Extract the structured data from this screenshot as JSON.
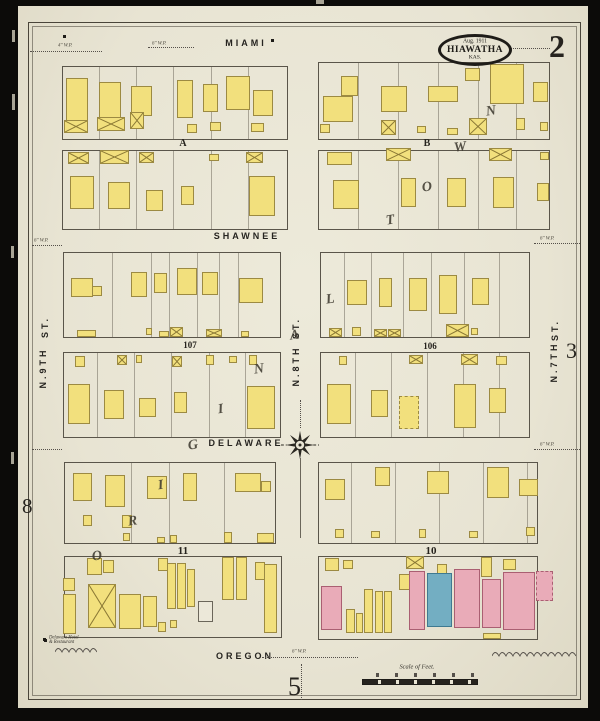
{
  "sheet": {
    "stamp": {
      "date": "Aug. 1911",
      "city": "HIAWATHA",
      "state": "KAS."
    },
    "sheet_number": "2",
    "adjacent_sheet_right": "3",
    "adjacent_sheet_left": "8",
    "adjacent_sheet_bottom": "5",
    "scale_label": "Scale of Feet.",
    "plat_name": "ORIGINAL TOWN",
    "note": {
      "line1": "Delaware Hotel",
      "line2": "& Restaurant"
    }
  },
  "colors": {
    "paper": "#e8e4d3",
    "frame_yellow": "#f2e07d",
    "brick_pink": "#e9abb8",
    "stone_blue": "#73aec2",
    "ink": "#26231e"
  },
  "map": {
    "street_labels": [
      {
        "t": "MIAMI",
        "x": 246,
        "y": 43,
        "r": 0
      },
      {
        "t": "SHAWNEE",
        "x": 247,
        "y": 236,
        "r": 0
      },
      {
        "t": "DELAWARE",
        "x": 246,
        "y": 443,
        "r": 0
      },
      {
        "t": "OREGON",
        "x": 245,
        "y": 656,
        "r": 0
      },
      {
        "t": "ST.",
        "x": 45,
        "y": 327,
        "r": -90
      },
      {
        "t": "N.9TH",
        "x": 43,
        "y": 368,
        "r": -90
      },
      {
        "t": "ST.",
        "x": 296,
        "y": 328,
        "r": -90
      },
      {
        "t": "N.8TH",
        "x": 296,
        "y": 366,
        "r": -90
      },
      {
        "t": "ST.",
        "x": 555,
        "y": 330,
        "r": -90
      },
      {
        "t": "N.7TH",
        "x": 554,
        "y": 362,
        "r": -90
      }
    ],
    "block_labels": [
      {
        "t": "A",
        "x": 183,
        "y": 138,
        "s": 10
      },
      {
        "t": "B",
        "x": 427,
        "y": 138,
        "s": 10
      },
      {
        "t": "107",
        "x": 190,
        "y": 340,
        "s": 9
      },
      {
        "t": "106",
        "x": 430,
        "y": 341,
        "s": 9
      },
      {
        "t": "11",
        "x": 183,
        "y": 545,
        "s": 11
      },
      {
        "t": "10",
        "x": 431,
        "y": 545,
        "s": 11
      }
    ],
    "plat_letters": [
      {
        "ch": "O",
        "x": 92,
        "y": 549
      },
      {
        "ch": "R",
        "x": 128,
        "y": 514
      },
      {
        "ch": "I",
        "x": 158,
        "y": 478
      },
      {
        "ch": "G",
        "x": 188,
        "y": 438
      },
      {
        "ch": "I",
        "x": 218,
        "y": 402
      },
      {
        "ch": "N",
        "x": 254,
        "y": 362
      },
      {
        "ch": "A",
        "x": 290,
        "y": 328
      },
      {
        "ch": "L",
        "x": 326,
        "y": 292
      },
      {
        "ch": "T",
        "x": 386,
        "y": 213
      },
      {
        "ch": "O",
        "x": 422,
        "y": 180
      },
      {
        "ch": "W",
        "x": 454,
        "y": 140
      },
      {
        "ch": "N",
        "x": 486,
        "y": 104
      }
    ],
    "blocks": [
      {
        "x": 62,
        "y": 66,
        "w": 226,
        "h": 74,
        "lots": [
          99,
          136,
          173,
          211,
          248
        ]
      },
      {
        "x": 318,
        "y": 62,
        "w": 232,
        "h": 78,
        "lots": [
          358,
          398,
          438,
          478,
          516
        ]
      },
      {
        "x": 62,
        "y": 150,
        "w": 226,
        "h": 80,
        "lots": [
          99,
          136,
          173,
          211,
          248
        ]
      },
      {
        "x": 318,
        "y": 150,
        "w": 232,
        "h": 80,
        "lots": [
          358,
          398,
          438,
          478,
          516
        ]
      },
      {
        "x": 63,
        "y": 252,
        "w": 218,
        "h": 86,
        "lots": [
          112,
          151,
          169,
          197,
          219,
          238
        ]
      },
      {
        "x": 320,
        "y": 252,
        "w": 210,
        "h": 86,
        "lots": [
          344,
          371,
          403,
          431,
          464,
          499
        ]
      },
      {
        "x": 63,
        "y": 352,
        "w": 218,
        "h": 86,
        "lots": [
          97,
          134,
          171,
          209,
          245
        ]
      },
      {
        "x": 320,
        "y": 352,
        "w": 210,
        "h": 86,
        "lots": [
          355,
          391,
          427,
          463,
          499
        ]
      },
      {
        "x": 64,
        "y": 462,
        "w": 212,
        "h": 82,
        "lots": [
          131,
          169,
          224
        ]
      },
      {
        "x": 318,
        "y": 462,
        "w": 220,
        "h": 82,
        "lots": [
          351,
          395,
          439,
          483,
          527
        ]
      },
      {
        "x": 64,
        "y": 556,
        "w": 218,
        "h": 82,
        "lots": []
      },
      {
        "x": 318,
        "y": 556,
        "w": 220,
        "h": 84,
        "lots": []
      }
    ],
    "buildings": [
      [
        66,
        78,
        22,
        44
      ],
      [
        99,
        82,
        22,
        38
      ],
      [
        131,
        86,
        21,
        30
      ],
      [
        177,
        80,
        16,
        38
      ],
      [
        203,
        84,
        15,
        28
      ],
      [
        226,
        76,
        24,
        34
      ],
      [
        253,
        90,
        20,
        26
      ],
      [
        64,
        120,
        24,
        13,
        "y",
        "x"
      ],
      [
        97,
        117,
        28,
        14,
        "y",
        "x"
      ],
      [
        130,
        112,
        14,
        17,
        "y",
        "x"
      ],
      [
        187,
        124,
        10,
        9
      ],
      [
        210,
        122,
        11,
        9
      ],
      [
        251,
        123,
        13,
        9
      ],
      [
        323,
        96,
        30,
        26
      ],
      [
        341,
        76,
        17,
        20
      ],
      [
        381,
        86,
        26,
        26
      ],
      [
        428,
        86,
        30,
        16
      ],
      [
        465,
        68,
        15,
        13
      ],
      [
        490,
        64,
        34,
        40
      ],
      [
        533,
        82,
        15,
        20
      ],
      [
        381,
        120,
        15,
        15,
        "y",
        "x"
      ],
      [
        469,
        118,
        18,
        17,
        "y",
        "x"
      ],
      [
        320,
        124,
        10,
        9
      ],
      [
        417,
        126,
        9,
        7
      ],
      [
        447,
        128,
        11,
        7
      ],
      [
        516,
        118,
        9,
        12
      ],
      [
        540,
        122,
        8,
        9
      ],
      [
        68,
        152,
        21,
        12,
        "y",
        "x"
      ],
      [
        100,
        150,
        29,
        14,
        "y",
        "x"
      ],
      [
        139,
        152,
        15,
        11,
        "y",
        "x"
      ],
      [
        246,
        152,
        17,
        11,
        "y",
        "x"
      ],
      [
        209,
        154,
        10,
        7
      ],
      [
        70,
        176,
        24,
        33
      ],
      [
        108,
        182,
        22,
        27
      ],
      [
        146,
        190,
        17,
        21
      ],
      [
        181,
        186,
        13,
        19
      ],
      [
        249,
        176,
        26,
        40
      ],
      [
        327,
        152,
        25,
        13
      ],
      [
        386,
        148,
        25,
        13,
        "y",
        "x"
      ],
      [
        489,
        148,
        23,
        13,
        "y",
        "x"
      ],
      [
        540,
        152,
        9,
        8
      ],
      [
        333,
        180,
        26,
        29
      ],
      [
        401,
        178,
        15,
        29
      ],
      [
        447,
        178,
        19,
        29
      ],
      [
        493,
        177,
        21,
        31
      ],
      [
        537,
        183,
        12,
        18
      ],
      [
        71,
        278,
        22,
        19
      ],
      [
        92,
        286,
        10,
        10
      ],
      [
        131,
        272,
        16,
        25
      ],
      [
        154,
        273,
        13,
        20
      ],
      [
        177,
        268,
        20,
        27
      ],
      [
        202,
        272,
        16,
        23
      ],
      [
        239,
        278,
        24,
        25
      ],
      [
        77,
        330,
        19,
        7
      ],
      [
        146,
        328,
        6,
        7
      ],
      [
        159,
        331,
        10,
        6
      ],
      [
        170,
        327,
        13,
        10,
        "y",
        "x"
      ],
      [
        206,
        329,
        16,
        8,
        "y",
        "x"
      ],
      [
        241,
        331,
        8,
        6
      ],
      [
        347,
        280,
        20,
        25
      ],
      [
        379,
        278,
        13,
        29
      ],
      [
        409,
        278,
        18,
        33
      ],
      [
        439,
        275,
        18,
        39
      ],
      [
        472,
        278,
        17,
        27
      ],
      [
        329,
        328,
        13,
        9,
        "y",
        "x"
      ],
      [
        352,
        327,
        9,
        9
      ],
      [
        374,
        329,
        13,
        8,
        "y",
        "x"
      ],
      [
        388,
        329,
        13,
        8,
        "y",
        "x"
      ],
      [
        446,
        324,
        23,
        13,
        "y",
        "x"
      ],
      [
        471,
        328,
        7,
        7
      ],
      [
        75,
        356,
        10,
        11
      ],
      [
        117,
        355,
        10,
        10,
        "y",
        "x"
      ],
      [
        136,
        355,
        6,
        8
      ],
      [
        172,
        356,
        10,
        11,
        "y",
        "x"
      ],
      [
        206,
        355,
        8,
        10
      ],
      [
        229,
        356,
        8,
        7
      ],
      [
        249,
        355,
        8,
        10
      ],
      [
        68,
        384,
        22,
        40
      ],
      [
        104,
        390,
        20,
        29
      ],
      [
        139,
        398,
        17,
        19
      ],
      [
        174,
        392,
        13,
        21
      ],
      [
        247,
        386,
        28,
        43
      ],
      [
        339,
        356,
        8,
        9
      ],
      [
        409,
        355,
        14,
        9,
        "y",
        "x"
      ],
      [
        461,
        354,
        17,
        11,
        "y",
        "x"
      ],
      [
        496,
        356,
        11,
        9
      ],
      [
        327,
        384,
        24,
        40
      ],
      [
        371,
        390,
        17,
        27
      ],
      [
        399,
        396,
        20,
        33,
        "y",
        "d"
      ],
      [
        454,
        384,
        22,
        44
      ],
      [
        489,
        388,
        17,
        25
      ],
      [
        73,
        473,
        19,
        28
      ],
      [
        105,
        475,
        20,
        32
      ],
      [
        147,
        476,
        20,
        23
      ],
      [
        183,
        473,
        14,
        28
      ],
      [
        235,
        473,
        26,
        19
      ],
      [
        261,
        481,
        10,
        11
      ],
      [
        83,
        515,
        9,
        11
      ],
      [
        122,
        515,
        10,
        13
      ],
      [
        123,
        533,
        7,
        8
      ],
      [
        157,
        537,
        8,
        6
      ],
      [
        170,
        535,
        7,
        8
      ],
      [
        224,
        532,
        8,
        11
      ],
      [
        257,
        533,
        17,
        10
      ],
      [
        325,
        479,
        20,
        21
      ],
      [
        375,
        467,
        15,
        19
      ],
      [
        427,
        471,
        22,
        23
      ],
      [
        487,
        467,
        22,
        31
      ],
      [
        519,
        479,
        19,
        17
      ],
      [
        335,
        529,
        9,
        9
      ],
      [
        371,
        531,
        9,
        7
      ],
      [
        419,
        529,
        7,
        9
      ],
      [
        469,
        531,
        9,
        7
      ],
      [
        526,
        527,
        9,
        9
      ],
      [
        63,
        578,
        12,
        13
      ],
      [
        63,
        594,
        13,
        40
      ],
      [
        87,
        558,
        15,
        17
      ],
      [
        103,
        560,
        11,
        13
      ],
      [
        88,
        584,
        28,
        44,
        "y",
        "x"
      ],
      [
        119,
        594,
        22,
        35
      ],
      [
        143,
        596,
        14,
        31
      ],
      [
        158,
        558,
        10,
        13
      ],
      [
        167,
        563,
        9,
        46
      ],
      [
        177,
        563,
        9,
        46
      ],
      [
        187,
        569,
        8,
        38
      ],
      [
        198,
        601,
        15,
        21,
        "w"
      ],
      [
        222,
        557,
        12,
        43
      ],
      [
        236,
        557,
        11,
        43
      ],
      [
        255,
        562,
        10,
        18
      ],
      [
        264,
        564,
        13,
        69
      ],
      [
        158,
        622,
        8,
        10
      ],
      [
        170,
        620,
        7,
        8
      ],
      [
        325,
        558,
        14,
        13
      ],
      [
        343,
        560,
        10,
        9
      ],
      [
        406,
        556,
        18,
        13,
        "y",
        "x"
      ],
      [
        437,
        564,
        10,
        11
      ],
      [
        321,
        586,
        21,
        44,
        "p"
      ],
      [
        346,
        609,
        9,
        24
      ],
      [
        356,
        613,
        7,
        20
      ],
      [
        364,
        589,
        9,
        44
      ],
      [
        375,
        591,
        8,
        42
      ],
      [
        384,
        591,
        8,
        42
      ],
      [
        399,
        574,
        11,
        16
      ],
      [
        409,
        571,
        16,
        59,
        "p"
      ],
      [
        427,
        573,
        25,
        54,
        "b"
      ],
      [
        454,
        569,
        26,
        59,
        "p"
      ],
      [
        481,
        557,
        11,
        20
      ],
      [
        482,
        579,
        19,
        49,
        "p"
      ],
      [
        503,
        559,
        13,
        11
      ],
      [
        503,
        572,
        32,
        58,
        "p"
      ],
      [
        536,
        571,
        17,
        30,
        "p",
        "d"
      ],
      [
        483,
        633,
        18,
        6
      ]
    ],
    "dotted_lines": [
      [
        30,
        51,
        72,
        0
      ],
      [
        148,
        47,
        46,
        0
      ],
      [
        510,
        48,
        40,
        0
      ],
      [
        32,
        245,
        30,
        0
      ],
      [
        534,
        243,
        46,
        0
      ],
      [
        32,
        449,
        30,
        0
      ],
      [
        534,
        449,
        46,
        0
      ],
      [
        262,
        657,
        96,
        0
      ],
      [
        301,
        664,
        36,
        1
      ],
      [
        300,
        400,
        28,
        1
      ]
    ],
    "annotations": [
      {
        "t": "4\" W.P.",
        "x": 58,
        "y": 42
      },
      {
        "t": "6\" W.P.",
        "x": 152,
        "y": 40
      },
      {
        "t": "6\" W.P.",
        "x": 34,
        "y": 237
      },
      {
        "t": "6\" W.P.",
        "x": 540,
        "y": 235
      },
      {
        "t": "6\" W.P.",
        "x": 540,
        "y": 441
      },
      {
        "t": "6\" W.P.",
        "x": 292,
        "y": 648
      }
    ],
    "dots": [
      [
        271,
        39
      ],
      [
        63,
        35
      ],
      [
        43,
        638
      ]
    ],
    "squiggles": [
      {
        "x": 492,
        "y": 647,
        "w": 84
      },
      {
        "x": 55,
        "y": 643,
        "w": 42
      }
    ]
  }
}
